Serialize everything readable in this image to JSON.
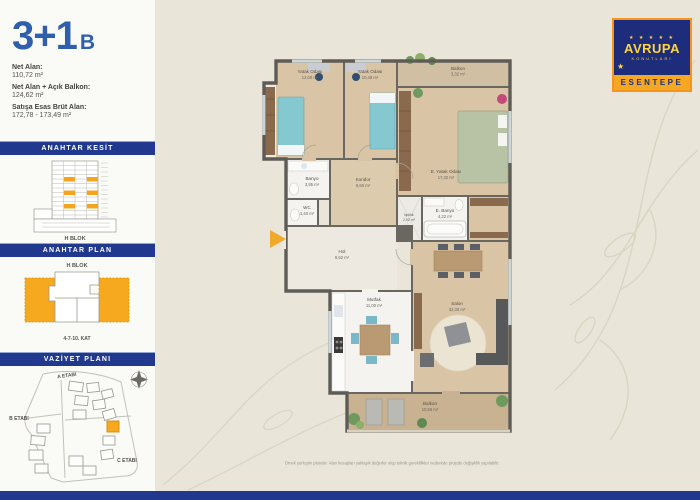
{
  "page": {
    "title_main": "3+1",
    "title_variant": "B"
  },
  "area_info": {
    "rows": [
      {
        "label": "Net Alan:",
        "value": "110,72 m²"
      },
      {
        "label": "Net Alan + Açık Balkon:",
        "value": "124,62 m²"
      },
      {
        "label": "Satışa Esas Brüt Alan:",
        "value": "172,78 - 173,49 m²"
      }
    ]
  },
  "sections": {
    "kesit": {
      "header": "ANAHTAR KESİT",
      "block_label": "H BLOK"
    },
    "plan": {
      "header": "ANAHTAR PLAN",
      "block_label": "H BLOK",
      "floor_label": "4-7-10. KAT"
    },
    "vaziyet": {
      "header": "VAZİYET PLANI",
      "labels": {
        "a": "A ETABI",
        "b": "B ETABI",
        "c": "C ETABI"
      }
    }
  },
  "logo": {
    "stars": "★ ★ ★ ★ ★",
    "brand": "AVRUPA",
    "brand_sub": "KONUTLARI",
    "project": "ESENTEPE"
  },
  "rooms": [
    {
      "name": "Yatak Odası",
      "area": "12,00 m²"
    },
    {
      "name": "Yatak Odası",
      "area": "10,48 m²"
    },
    {
      "name": "Balkon",
      "area": "3,32 m²"
    },
    {
      "name": "E. Yatak Odası",
      "area": "17,32 m²"
    },
    {
      "name": "Banyo",
      "area": "3,95 m²"
    },
    {
      "name": "WC",
      "area": "1,40 m²"
    },
    {
      "name": "Koridor",
      "area": "8,60 m²"
    },
    {
      "name": "Işıklık",
      "area": "2,52 m²"
    },
    {
      "name": "E. Banyo",
      "area": "4,22 m²"
    },
    {
      "name": "Hol",
      "area": "9,52 m²"
    },
    {
      "name": "Mutfak",
      "area": "11,00 m²"
    },
    {
      "name": "Salon",
      "area": "32,30 m²"
    },
    {
      "name": "Balkon",
      "area": "10,58 m²"
    }
  ],
  "footer": {
    "disclaimer": "Örnek yerleşim planıdır. Alan hesapları yaklaşık değerler olup teknik gereklilikler nedeniyle projede değişiklik yapılabilir."
  },
  "colors": {
    "navy": "#20398e",
    "orange": "#f6a91e",
    "title_blue": "#2e5fae",
    "logo_yellow": "#ffd63c",
    "beige": "#e9e6d9"
  }
}
